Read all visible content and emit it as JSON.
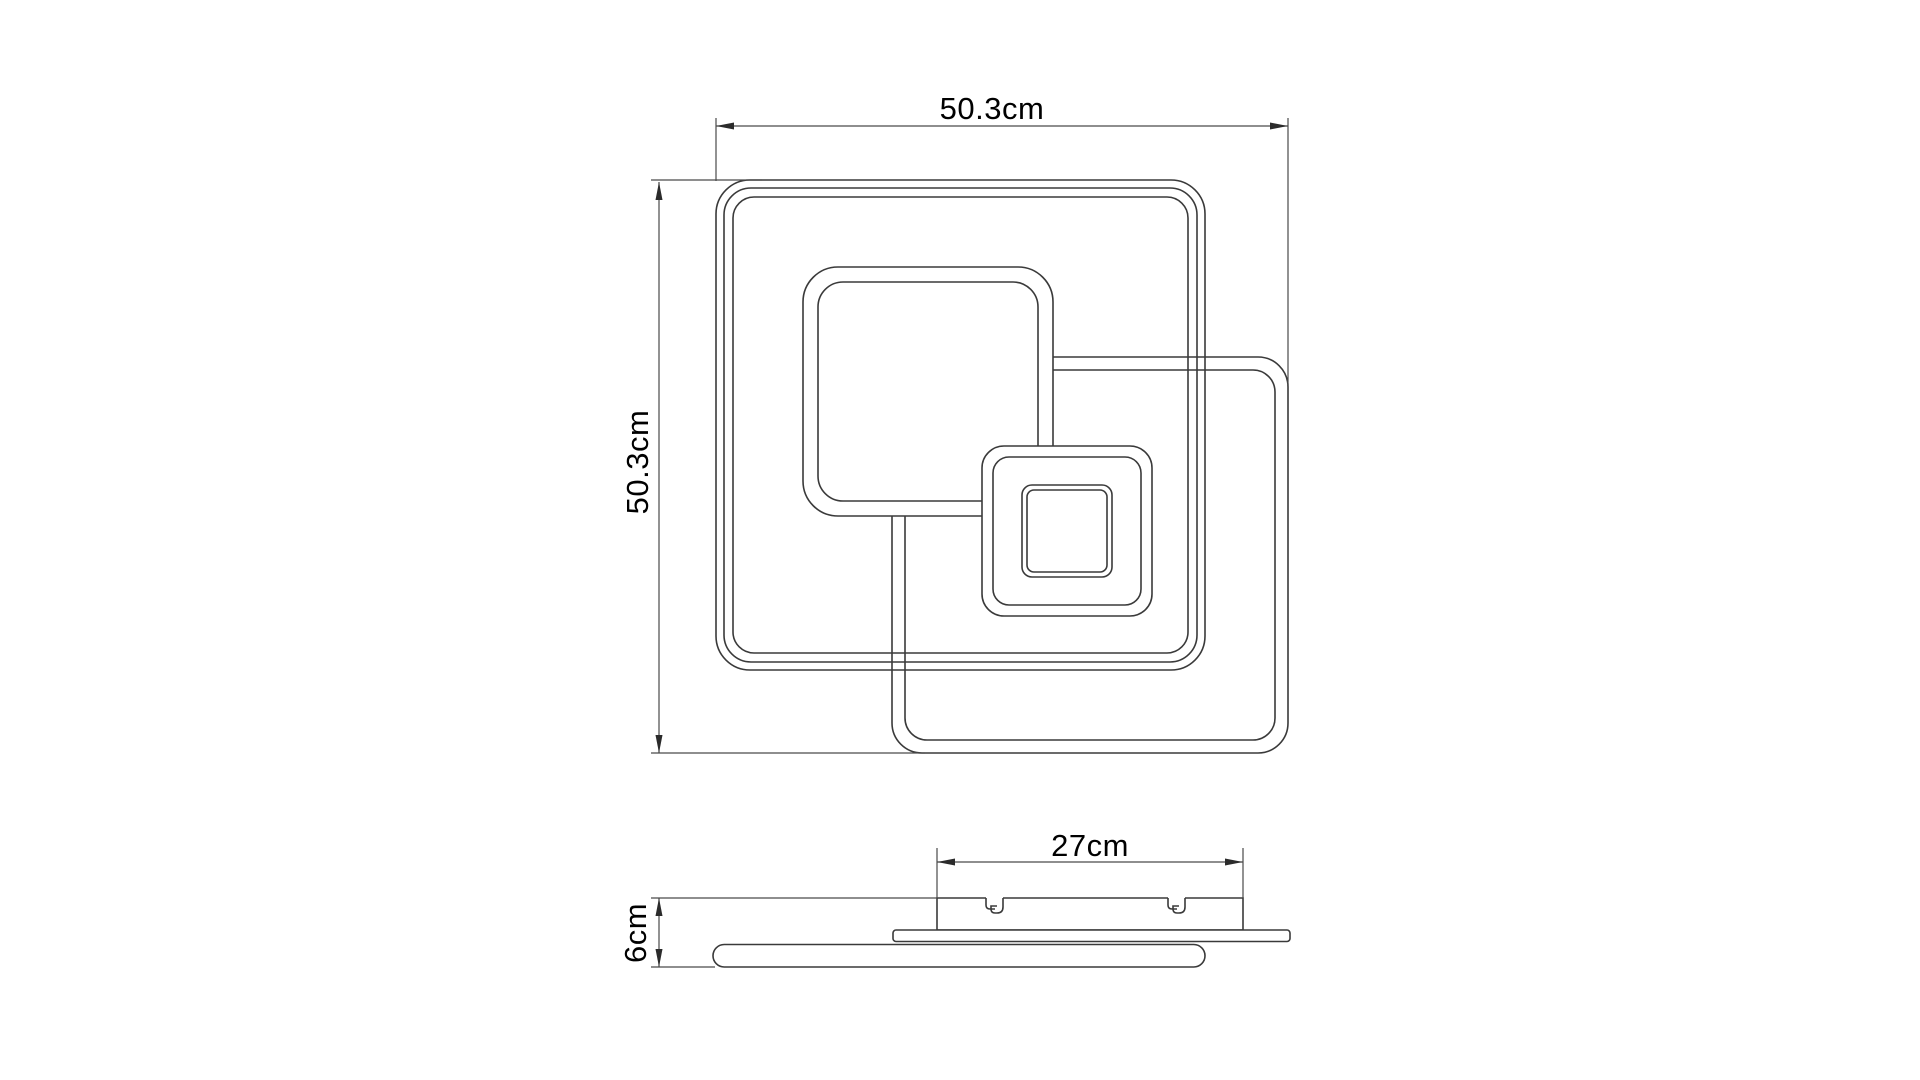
{
  "drawing": {
    "type": "technical-dimension-drawing",
    "subject": "square-led-ceiling-light",
    "background_color": "#ffffff",
    "line_color": "#3a3a3a",
    "dimension_line_color": "#4a4a4a",
    "text_color": "#000000"
  },
  "dimensions": {
    "top_width": {
      "label": "50.3cm"
    },
    "left_height": {
      "label": "50.3cm"
    },
    "canopy_width": {
      "label": "27cm"
    },
    "profile_height": {
      "label": "6cm"
    }
  }
}
